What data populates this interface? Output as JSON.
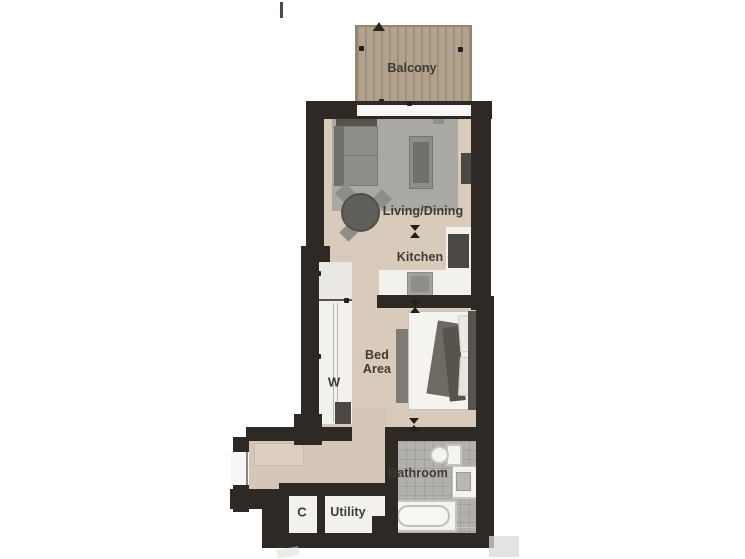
{
  "plan": {
    "type": "apartment-floor-plan",
    "labels": {
      "balcony": "Balcony",
      "living_dining": "Living/Dining",
      "kitchen": "Kitchen",
      "bed_area": "Bed Area",
      "wardrobe": "W",
      "bathroom": "Bathroom",
      "cupboard": "C",
      "utility": "Utility"
    },
    "colors": {
      "background": "#ffffff",
      "wall": "#2e2924",
      "floor": "#d8cbbc",
      "balcony_deck": "#b2a28d",
      "rug": "#a9a8a4",
      "bathroom_tile": "#b3b1ae",
      "fixture_white": "#f2f1ee",
      "furniture_grey": "#8d8d8a",
      "furniture_dark": "#4b4743",
      "label_text": "#3f3a33"
    }
  }
}
